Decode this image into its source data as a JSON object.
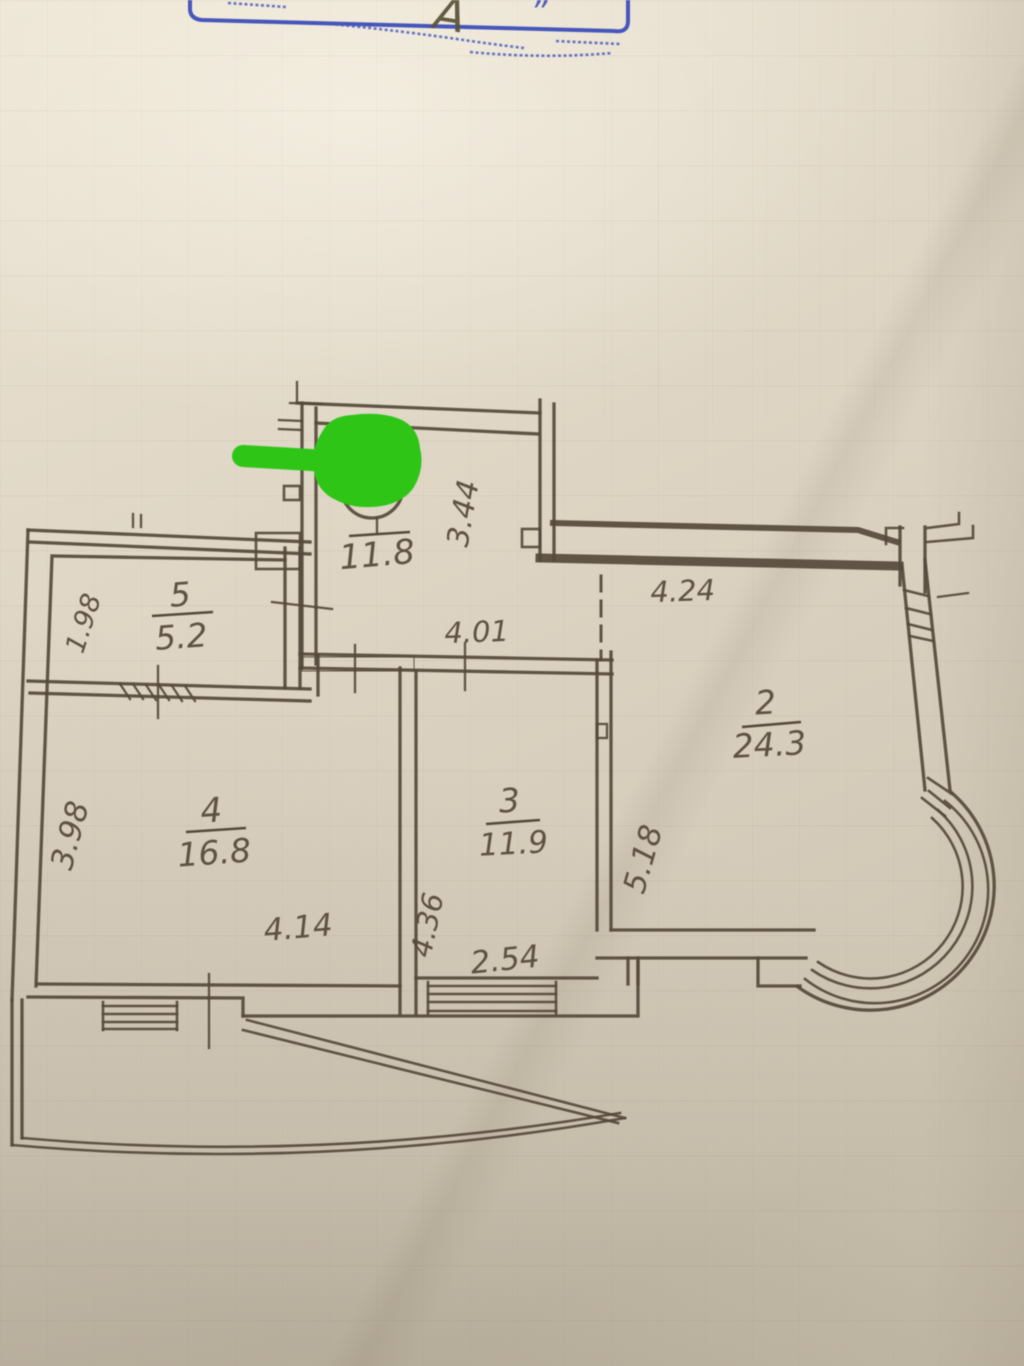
{
  "stamp": {
    "letter": "А",
    "quote": "”"
  },
  "rooms": {
    "kitchen": {
      "area": "11.8"
    },
    "room2": {
      "number": "2",
      "area": "24.3"
    },
    "room3": {
      "number": "3",
      "area": "11.9"
    },
    "room4": {
      "number": "4",
      "area": "16.8"
    },
    "room5": {
      "number": "5",
      "area": "5.2"
    }
  },
  "dimensions": {
    "kitchen_height": "3.44",
    "corridor_width": "4.01",
    "room2_width": "4.24",
    "room2_height": "5.18",
    "room3_width": "2.54",
    "room3_height": "4.36",
    "room4_width": "4.14",
    "room4_height": "3.98",
    "room5_height": "1.98"
  },
  "colors": {
    "ink": "#55493b",
    "stamp_blue": "#4656bb",
    "annotation_green": "#2fc517",
    "paper": "#d9cfbe"
  }
}
